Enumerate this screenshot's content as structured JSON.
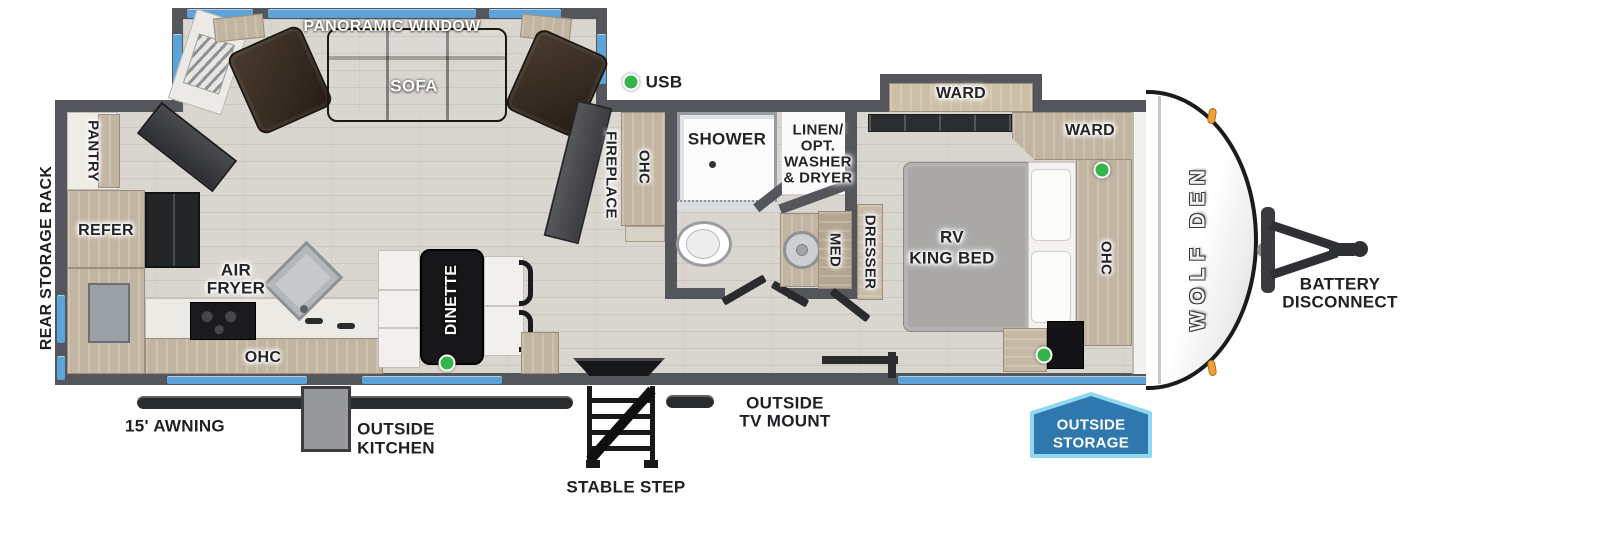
{
  "colors": {
    "wall_gray": "#55565b",
    "floor_wood": "#d9d5cf",
    "window_blue": "#5da3d8",
    "cabinet_tan": "#c1b4a1",
    "sofa_brown": "#37302a",
    "usb_green": "#35b44a",
    "badge_blue": "#2e78ae",
    "badge_border": "#8fd8f0",
    "marker_orange": "#f0a13a"
  },
  "brand": "WOLF DEN",
  "legend_usb": "USB",
  "living": {
    "panoramic_window": "PANORAMIC WINDOW",
    "sofa": "SOFA",
    "fireplace": "FIREPLACE",
    "ohc_cabinet": "OHC",
    "dinette": "DINETTE"
  },
  "kitchen": {
    "pantry": "PANTRY",
    "refer": "REFER",
    "air_fryer": [
      "AIR",
      "FRYER"
    ],
    "ohc": "OHC"
  },
  "bath": {
    "shower": "SHOWER",
    "linen": [
      "LINEN/",
      "OPT.",
      "WASHER",
      "& DRYER"
    ],
    "med": "MED"
  },
  "bedroom": {
    "ward_slide": "WARD",
    "ward_corner": "WARD",
    "bed": [
      "RV",
      "KING BED"
    ],
    "dresser": "DRESSER",
    "ohc": "OHC"
  },
  "exterior": {
    "rear_storage_rack": "REAR STORAGE RACK",
    "awning": "15' AWNING",
    "outside_kitchen": [
      "OUTSIDE",
      "KITCHEN"
    ],
    "stable_step": "STABLE STEP",
    "outside_tv_mount": [
      "OUTSIDE",
      "TV MOUNT"
    ],
    "outside_storage": [
      "OUTSIDE",
      "STORAGE"
    ],
    "battery_disconnect": [
      "BATTERY",
      "DISCONNECT"
    ]
  }
}
